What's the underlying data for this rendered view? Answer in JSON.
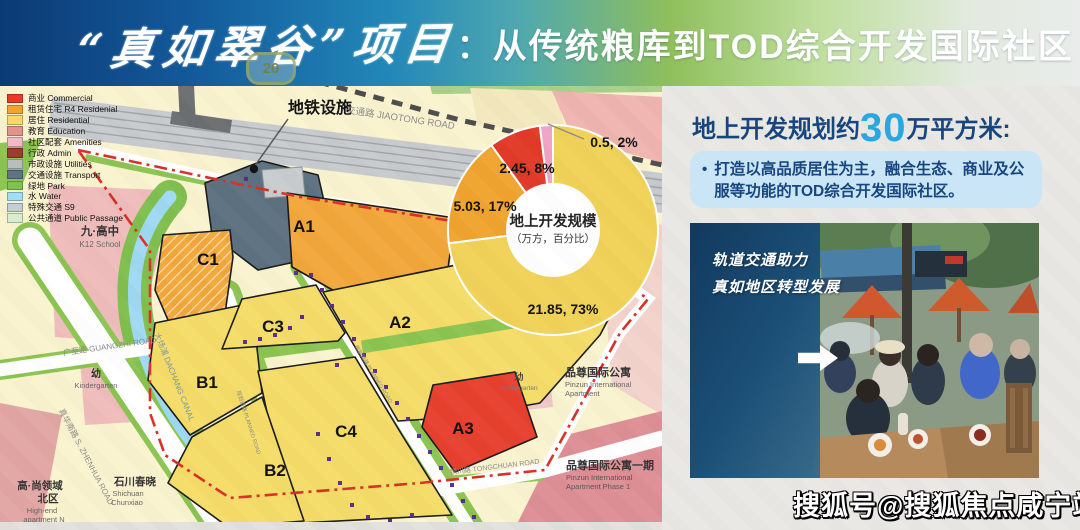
{
  "banner": {
    "title_script": "“真如翠谷”项目",
    "colon": "：",
    "title_rest": "从传统粮库到TOD综合开发国际社区",
    "route_badge": "20"
  },
  "legend": {
    "items": [
      {
        "label": "商业 Commercial",
        "color": "#E8392C"
      },
      {
        "label": "租赁住宅 R4 Residenial",
        "color": "#F0A42F"
      },
      {
        "label": "居住 Residential",
        "color": "#F5D96A"
      },
      {
        "label": "教育 Education",
        "color": "#E2938D"
      },
      {
        "label": "社区配套 Amenities",
        "color": "#F2BAC6"
      },
      {
        "label": "行政 Admin",
        "color": "#9E3A33"
      },
      {
        "label": "市政设施 Utilities",
        "color": "#B9BDBF"
      },
      {
        "label": "交通设施 Transport",
        "color": "#5F7384"
      },
      {
        "label": "绿地 Park",
        "color": "#7FC24F"
      },
      {
        "label": "水 Water",
        "color": "#A3DCF5"
      },
      {
        "label": "特殊交通 S9",
        "color": "#C2CDD4"
      },
      {
        "label": "公共通道 Public Passage",
        "color": "#D8EDD0"
      }
    ]
  },
  "map": {
    "metro_label": "地铁设施",
    "parcels": {
      "a1": "A1",
      "a2": "A2",
      "a3": "A3",
      "b1": "B1",
      "b2": "B2",
      "c1": "C1",
      "c3": "C3",
      "c4": "C4"
    },
    "roads": {
      "jiaotong": "交通路 JIAOTONG ROAD",
      "guangzhi": "广至路 GUANGZHI ROAD",
      "zhenhua": "真华南路 S. ZHENHUA ROAD",
      "dachang": "大场浦 DACHANG CANAL",
      "tongchuan": "铜川路 TONGCHUAN ROAD",
      "inner1": "规划道路 PLANNED ROAD",
      "inner2": "规划道路 PLANNED ROAD"
    },
    "places": {
      "school_cn": "九·高中",
      "school_en": "K12 School",
      "kind_l_cn": "幼",
      "kind_l_en": "Kindergarten",
      "kind_r_cn": "幼",
      "kind_r_en": "Kindergarten",
      "shichuan_cn": "石川春晓",
      "shichuan_en1": "Shichuan",
      "shichuan_en2": "Chunxiao",
      "highend_cn1": "高·尚领域",
      "highend_cn2": "北区",
      "highend_en1": "High-end",
      "highend_en2": "apartment N",
      "pinzun_cn": "品尊国际公寓",
      "pinzun_en1": "Pinzun International",
      "pinzun_en2": "Apartment",
      "pinzun1_cn": "品尊国际公寓一期",
      "pinzun1_en1": "Pinzun International",
      "pinzun1_en2": "Apartment Phase 1"
    }
  },
  "chart_data": {
    "type": "pie",
    "title": "地上开发规模",
    "subtitle": "（万方，百分比）",
    "unit": "万方 (10k sqm), percent",
    "slices": [
      {
        "name": "居住 Residential",
        "value": 21.85,
        "pct": 73,
        "label": "21.85, 73%",
        "color": "#F1D158"
      },
      {
        "name": "租赁住宅 R4",
        "value": 5.03,
        "pct": 17,
        "label": "5.03, 17%",
        "color": "#F0A42F"
      },
      {
        "name": "商业 Commercial",
        "value": 2.45,
        "pct": 8,
        "label": "2.45, 8%",
        "color": "#E23A28"
      },
      {
        "name": "其他",
        "value": 0.5,
        "pct": 2,
        "label": "0.5, 2%",
        "color": "#F0A3C5"
      }
    ],
    "legend_position": "none",
    "donut": true
  },
  "right_panel": {
    "heading_pre": "地上开发规划约",
    "heading_num": "30",
    "heading_post": "万平方米:",
    "bullet": "•",
    "body": "打造以高品质居住为主，融合生态、商业及公服等功能的TOD综合开发国际社区。"
  },
  "photo_card": {
    "line1": "轨道交通助力",
    "line2": "真如地区转型发展"
  },
  "watermark": "搜狐号@搜狐焦点咸宁站"
}
